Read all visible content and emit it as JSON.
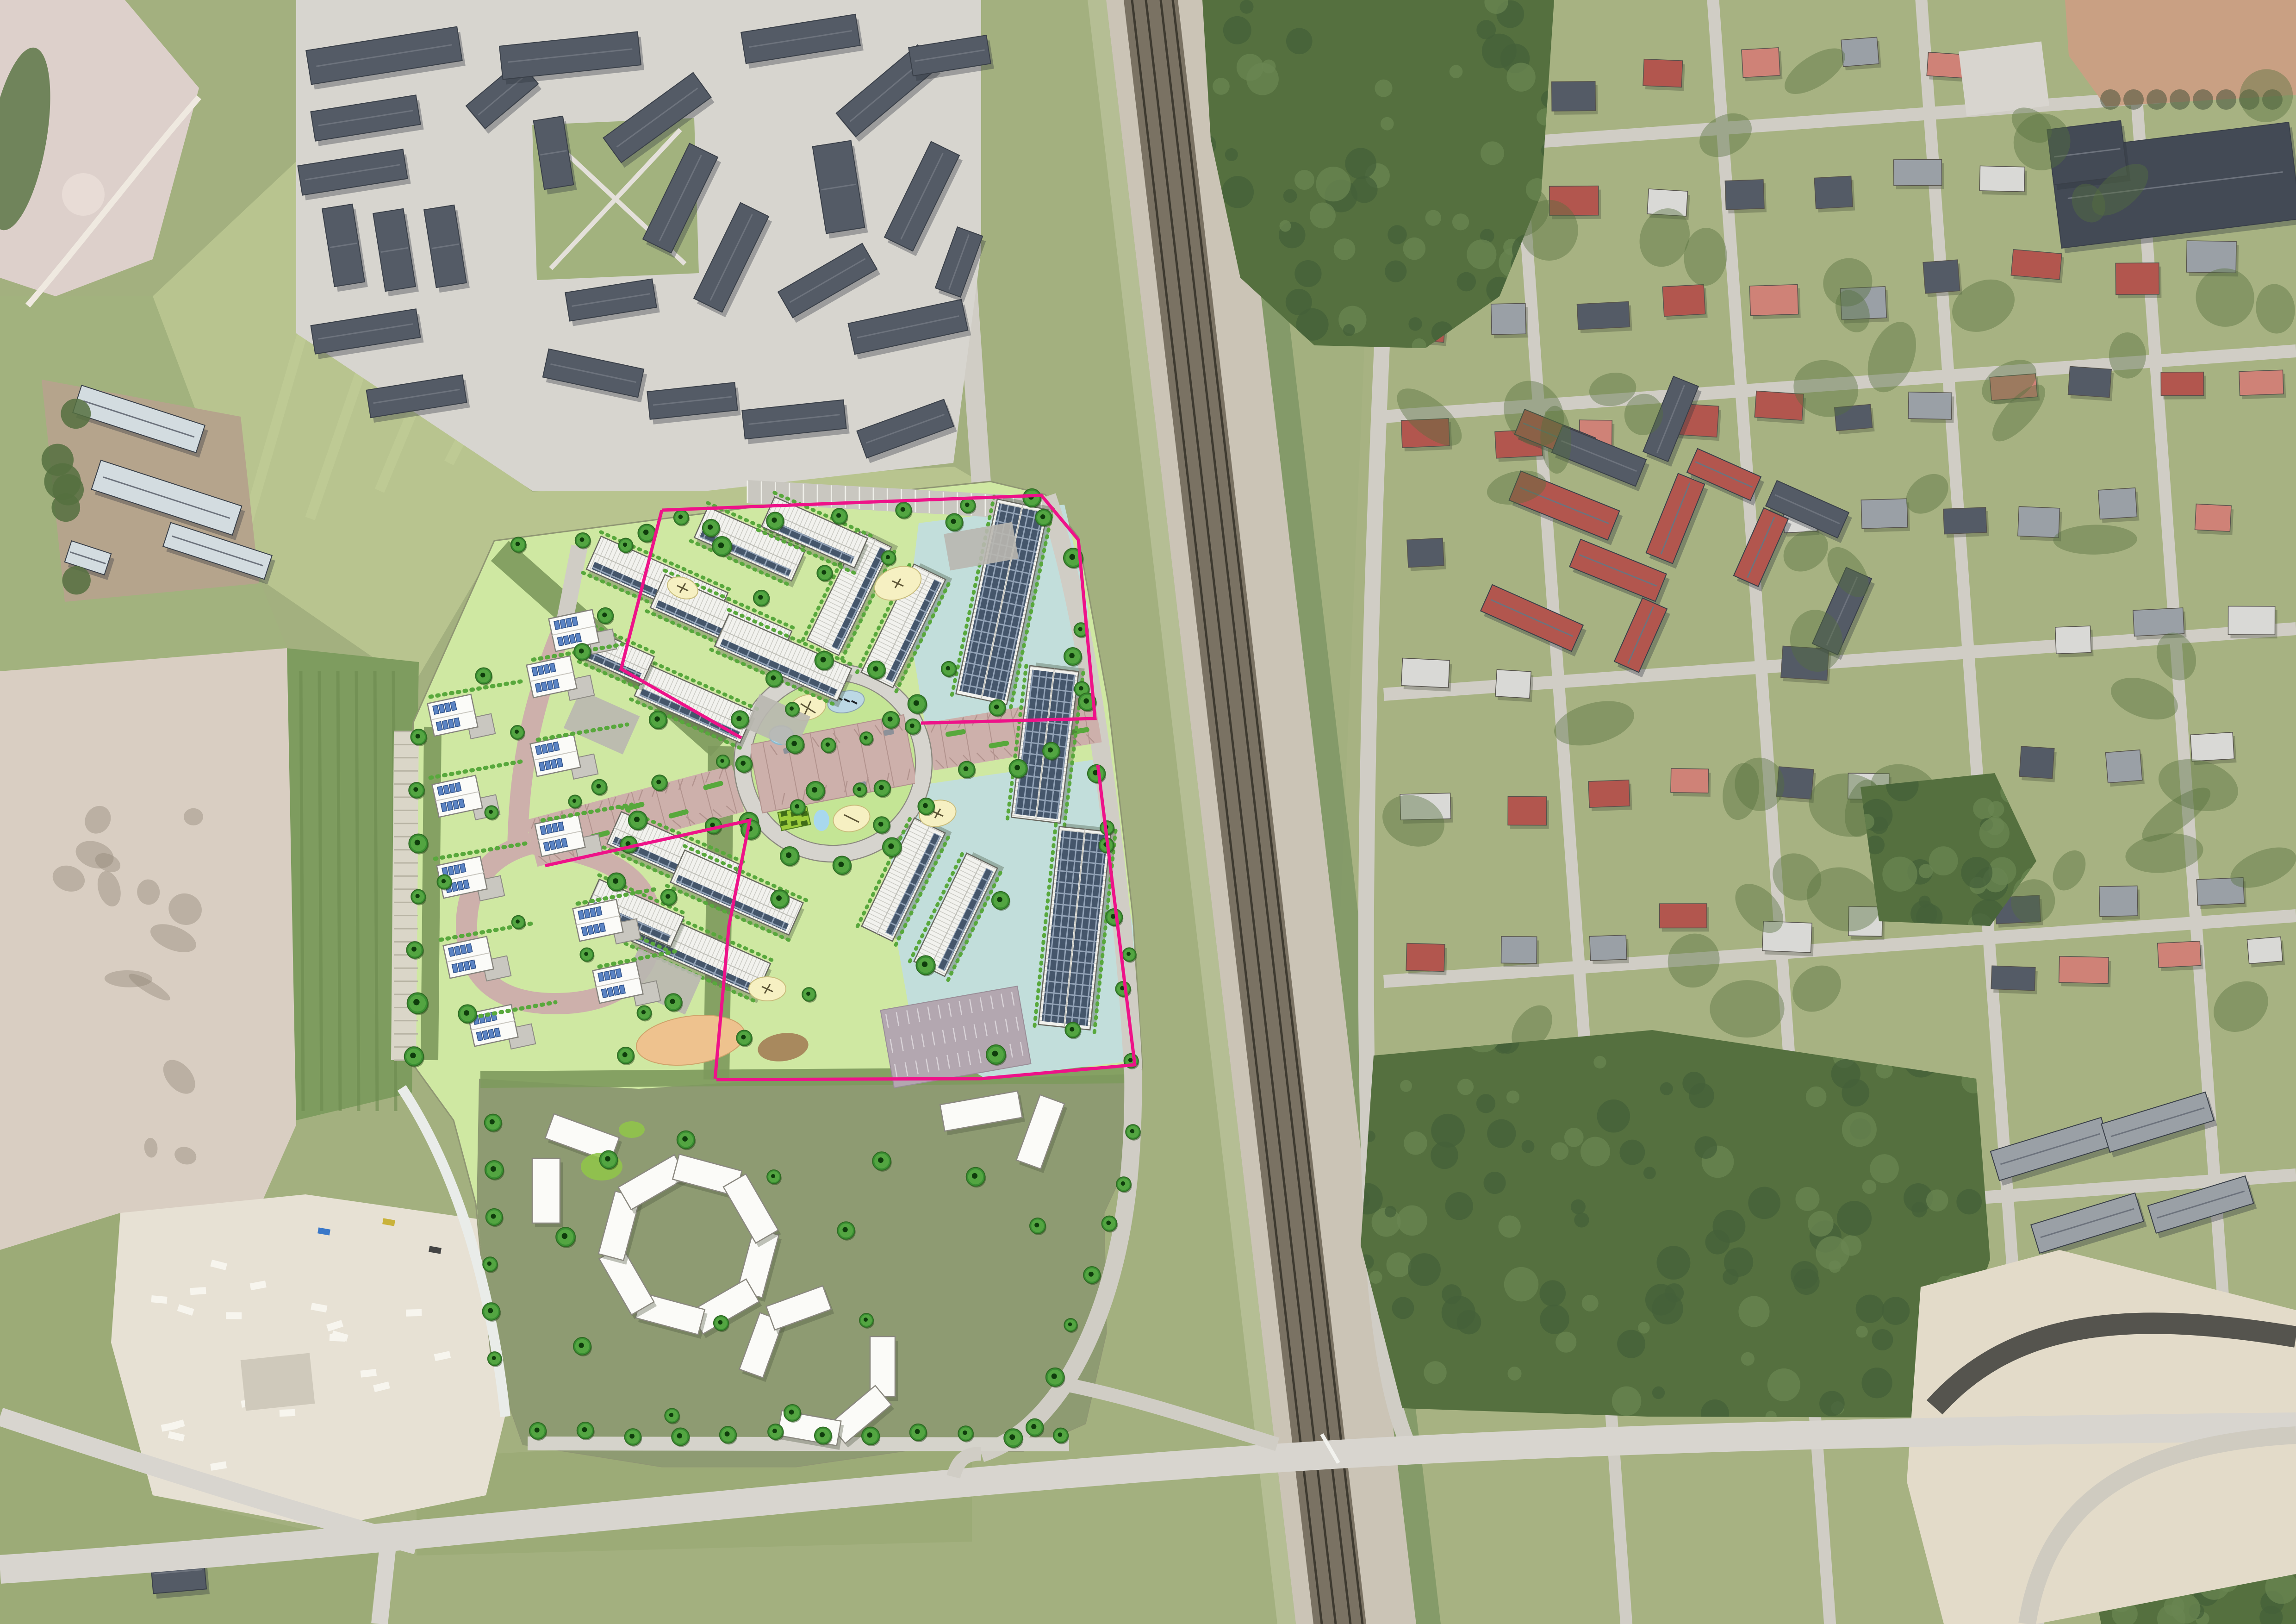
{
  "image": {
    "kind": "aerial-orthophoto-with-masterplan-overlay",
    "visible_text": "none"
  },
  "palette": {
    "base": "#a3b07f",
    "field_light": "#b8c48f",
    "field_mid": "#a2b27e",
    "field_dark": "#7e9c5f",
    "meadow": "#9cab77",
    "forest": "#55703f",
    "forest_dark": "#44603a",
    "forest_light": "#6a8551",
    "sand_clear": "#d9cec2",
    "sand_pit": "#e7e1d4",
    "pitch_tan": "#c9a083",
    "pitch_gray": "#ddd0cb",
    "road": "#d8d5cf",
    "road_minor": "#d0cdc5",
    "road_dark": "#55544e",
    "rail_gravel": "#cbc4b6",
    "rail_bed": "#7a7263",
    "rail_line": "#3e3a30",
    "rail_verge": "#7f9765",
    "pave": "#d7d5cf",
    "roof_dark": "#545b66",
    "roof_dark2": "#434a55",
    "roof_mid": "#9aa0a6",
    "roof_light": "#d9d9d6",
    "roof_red": "#b2564e",
    "roof_red_light": "#cf8277",
    "roof_white": "#f2f2ee",
    "farm_roof": "#d3dce0",
    "dirt": "#b5a48c",
    "plan_green": "#cfe8a2",
    "plan_yard": "#c4e595",
    "plan_green_dark": "#7e9a5d",
    "plan_olive": "#8e9b72",
    "hedge": "#58a83c",
    "hedge_dark": "#2f6b22",
    "tree_fill": "#3a8f33",
    "tree_rim": "#6cbb4f",
    "tree_core": "#0f3d0c",
    "street_rose": "#cdb0ab",
    "street_rose_line": "#b2938e",
    "ring_road": "#d6d4ce",
    "road_outline": "#8c8a80",
    "water": "#a8d8ee",
    "water_gray": "#bcd8e4",
    "suds_blue": "#c2dedb",
    "play_cream": "#f6f0c2",
    "sand_orange": "#eec28e",
    "mud_brown": "#a8895e",
    "solar_dark": "#45566b",
    "solar_grid": "#92a2b6",
    "boundary_pink": "#ee1289",
    "white_bldg": "#fbfbf8",
    "bldg_outline": "#67675f",
    "shadow": "#3c4a33",
    "pile_white": "#f7f5ee",
    "parking_mauve": "#b3a7b0",
    "lime_lawn": "#90c44a",
    "pale_path": "#e9ece9"
  },
  "overlay_facts": {
    "boundary_line_color": "#ee1289",
    "has_roundabout": true,
    "has_central_main_street": true,
    "planned_block_count": 4,
    "playground_count": 6,
    "pond_count": 3,
    "parking_lot_count": 3,
    "solar_roofs": true,
    "future_phase_white_buildings": true
  }
}
